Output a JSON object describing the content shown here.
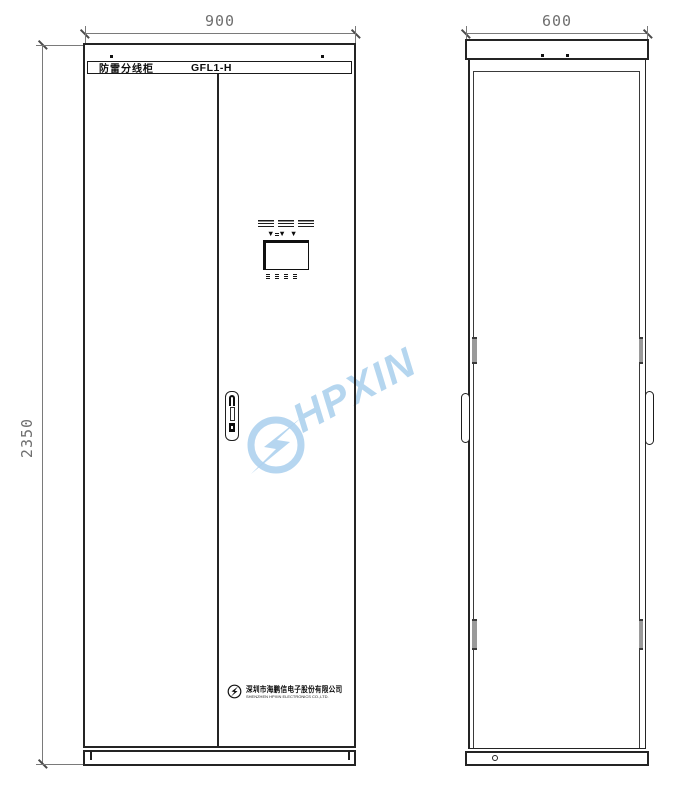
{
  "dimensions": {
    "front_width": "900",
    "side_width": "600",
    "height": "2350"
  },
  "title_plate": {
    "name": "防雷分线柜",
    "model": "GFL1-H"
  },
  "watermark": {
    "text": "HPXIN",
    "color": "#aed2ee"
  },
  "display_panel": {
    "indicator_glyphs": "▼▼▼"
  },
  "branding": {
    "company_cn": "深圳市海鹏信电子股份有限公司",
    "company_en": "SHENZHEN HPXIN ELECTRONICS CO.,LTD."
  },
  "colors": {
    "cabinet_line": "#242424",
    "dimension_gray": "#6f6f6f",
    "hinge_gray": "#9a9a9a"
  }
}
